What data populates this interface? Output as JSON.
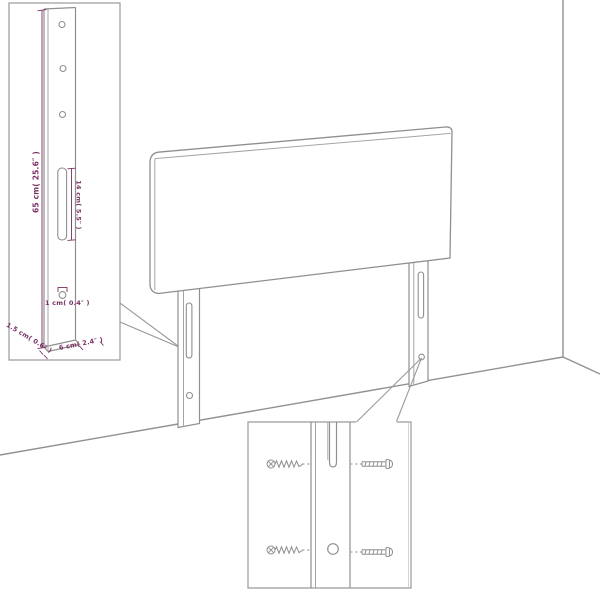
{
  "diagram": {
    "title": "headboard-dimension-and-assembly-diagram",
    "colors": {
      "background": "#ffffff",
      "line": "#8f8f8f",
      "inner_line": "#a5a5a5",
      "box_border": "#9a9a9a",
      "dimension_text": "#7a3062"
    },
    "left_inset": {
      "dimensions": {
        "height": "65 cm( 25.6″ )",
        "slot_length": "14 cm( 5.5″ )",
        "hole_diameter": "1 cm( 0.4″ )",
        "thickness": "1.5 cm( 0.6″ )",
        "width": "6 cm( 2.4″ )"
      },
      "features": {
        "holes_top": 3,
        "slot": 1,
        "hole_bottom": 1
      }
    },
    "hardware_inset": {
      "wood_screws": 2,
      "machine_screws": 2,
      "holes_shown": [
        "slot",
        "round-hole"
      ]
    }
  }
}
